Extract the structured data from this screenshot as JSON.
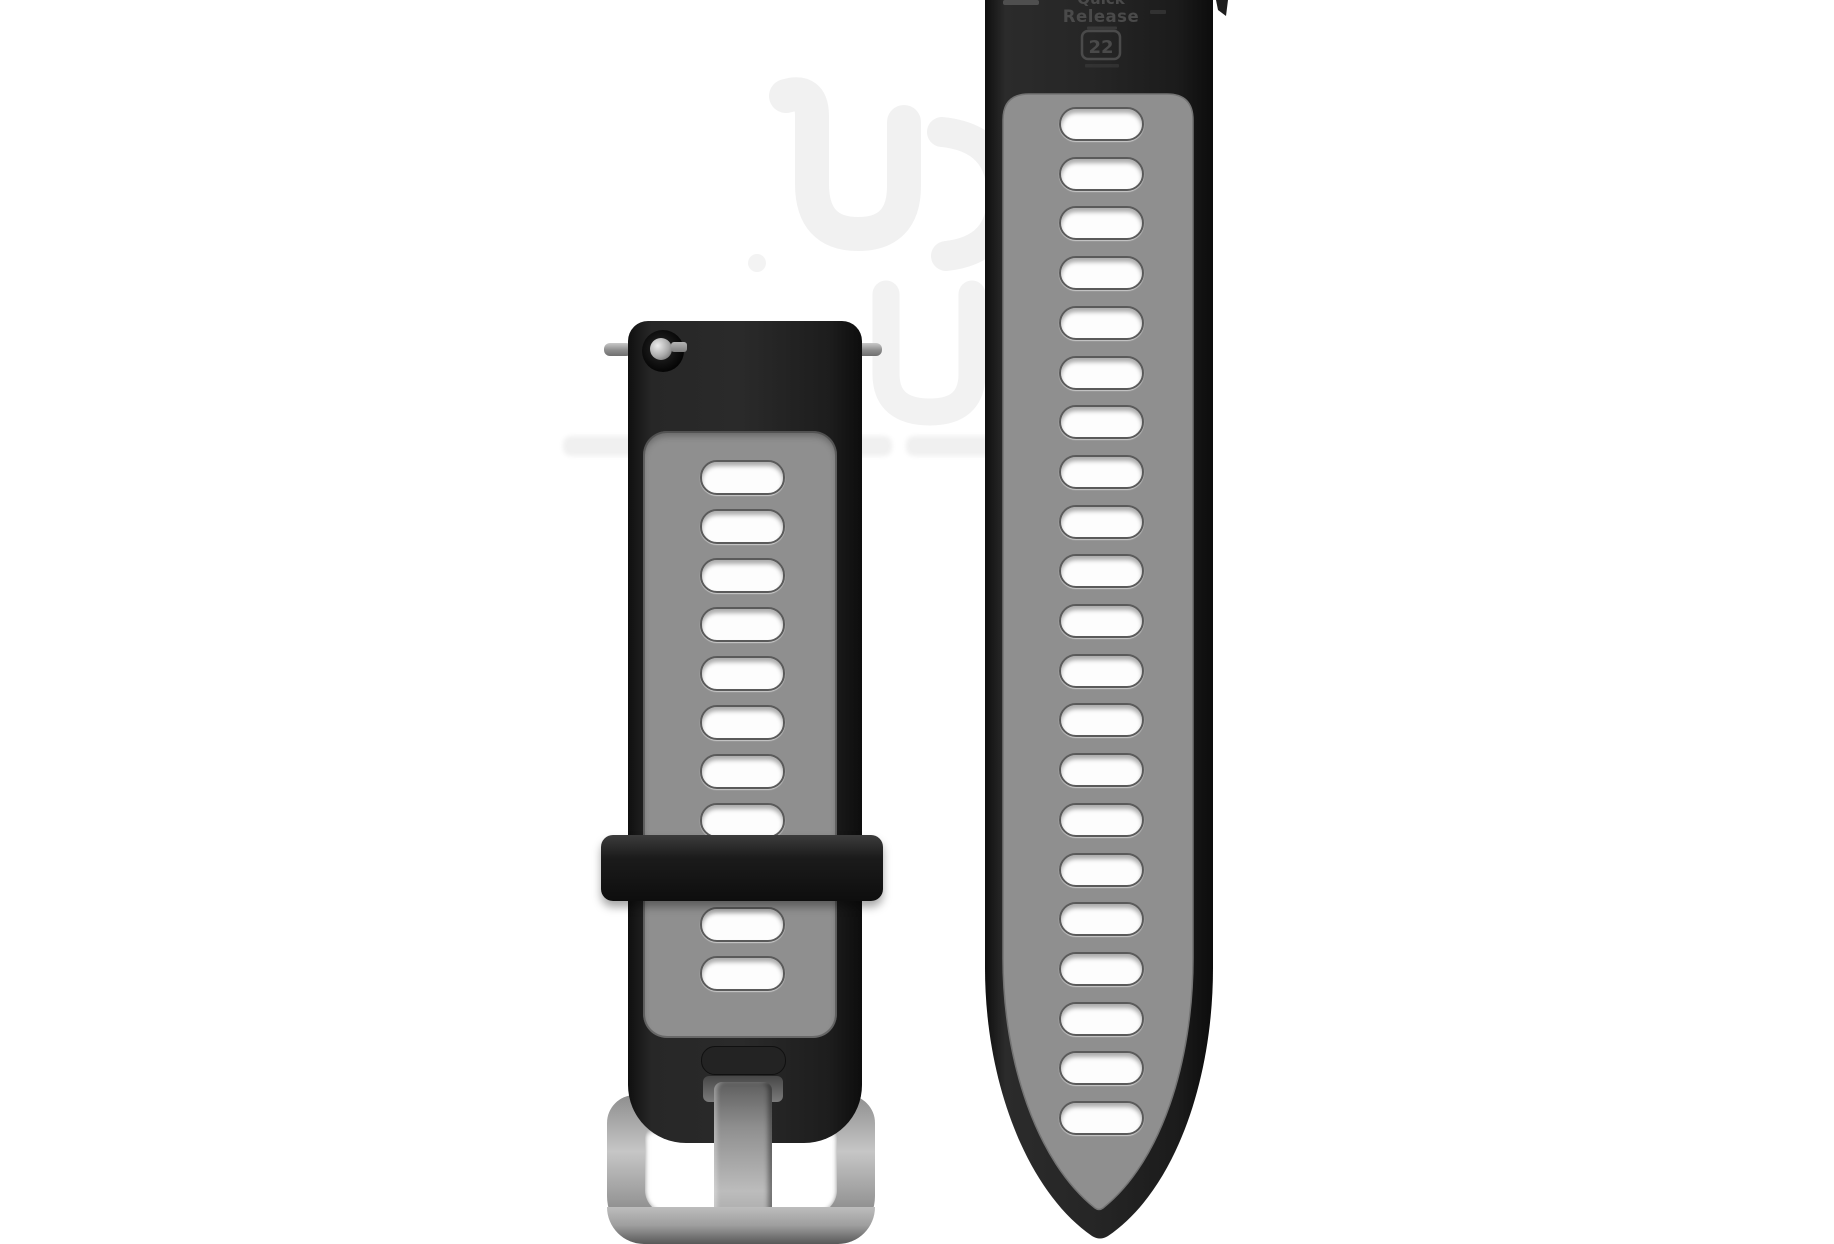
{
  "photo": {
    "background_color": "#ffffff",
    "subject": "Two-piece quick-release silicone watch band, black outer with gray perforated center, black keeper loop and silver buckle"
  },
  "engraving": {
    "line1": "Quick",
    "line2": "Release",
    "size_badge": "22"
  },
  "band": {
    "right_piece": {
      "holes": 21
    },
    "left_piece": {
      "holes_above_keeper": 8,
      "holes_below_keeper": 2
    }
  },
  "colors": {
    "strap_black": "#1e1e1e",
    "center_gray": "#8f8f8f",
    "hole_white": "#fdfdfd",
    "buckle_silver": "#b0b0b0",
    "engraving_gray": "#4a4a4a",
    "watermark_gray": "#f1f1f1"
  },
  "watermark": {
    "present": true,
    "text_legible": false
  }
}
